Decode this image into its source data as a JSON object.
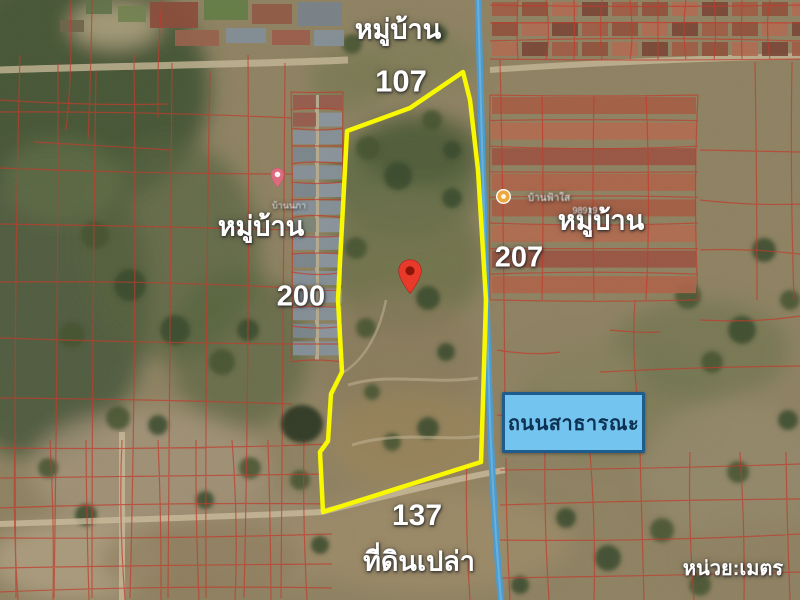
{
  "labels": {
    "village_top": "หมู่บ้าน",
    "village_left": "หมู่บ้าน",
    "village_right": "หมู่บ้าน",
    "side_north": "107",
    "side_west": "200",
    "side_east": "207",
    "side_south": "137",
    "vacant_land": "ที่ดินเปล่า",
    "public_road": "ถนนสาธารณะ",
    "unit": "หน่วย:เมตร",
    "poi_left": "บ้านนภา",
    "poi_right": "บ้านฟ้าใส",
    "poi_right_sub": "98919"
  },
  "colors": {
    "boundary": "#f8f800",
    "road": "#4e9bcf",
    "parcel": "#c03828",
    "pin": "#e8392b",
    "badge-bg": "#74c4f0",
    "badge-border": "#1d5c8c",
    "badge-text": "#0c3152",
    "label": "#ffffff"
  }
}
